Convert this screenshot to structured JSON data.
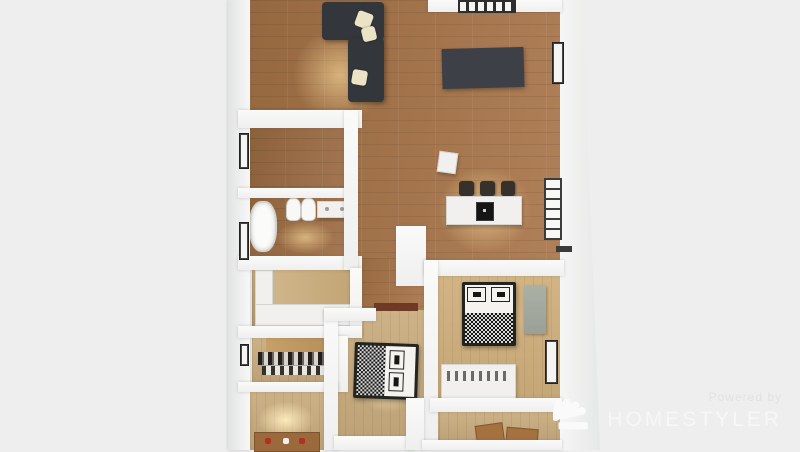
{
  "watermark": {
    "powered_by": "Powered by",
    "brand": "HOMESTYLER",
    "logo_icon": "homestyler-fan-icon"
  },
  "scene": {
    "kind": "3d-floorplan-top-view-render",
    "background": "#edeeed",
    "palette": {
      "background": "#edeeed",
      "wall": "#eeefee",
      "floor_main": "#b08058",
      "floor_main_dark": "#96683f",
      "floor_bedroom": "#cdb288",
      "floor_bright": "#f2e0b2",
      "sofa": "#33373c",
      "dark_rug": "#3d4147",
      "island": "#f1f0ee",
      "cooktop": "#151515",
      "stool": "#37312b",
      "bed_frame": "#23231f",
      "bed_linen": "#f4f3ef",
      "wardrobe_panel": "#9aa096",
      "door_rug": "#6e3a26",
      "table_wood": "#9a6a3c",
      "watermark_text": "#f7f7f7",
      "watermark_sub": "#e2e2e2"
    },
    "rooms": [
      "living-dining-kitchen",
      "study-room",
      "bathroom",
      "utility-room",
      "walk-in-closet",
      "hallway",
      "bedroom-middle",
      "bedroom-right",
      "bottom-left-room",
      "bottom-right-room"
    ],
    "furniture": [
      "sectional-sofa",
      "sofa-pillows",
      "dark-area-rug",
      "top-grid-window",
      "white-speaker-box",
      "kitchen-island",
      "cooktop",
      "bar-stools",
      "bathtub",
      "toilet",
      "toilet",
      "vanity-counter",
      "utility-cabinets",
      "closet-clothes-rail",
      "shoe-rack",
      "double-bed-middle",
      "entry-rug",
      "double-bed-right",
      "wardrobe-panel",
      "dresser-shelf",
      "dining-table-small",
      "wooden-chairs",
      "wall-windows"
    ]
  }
}
